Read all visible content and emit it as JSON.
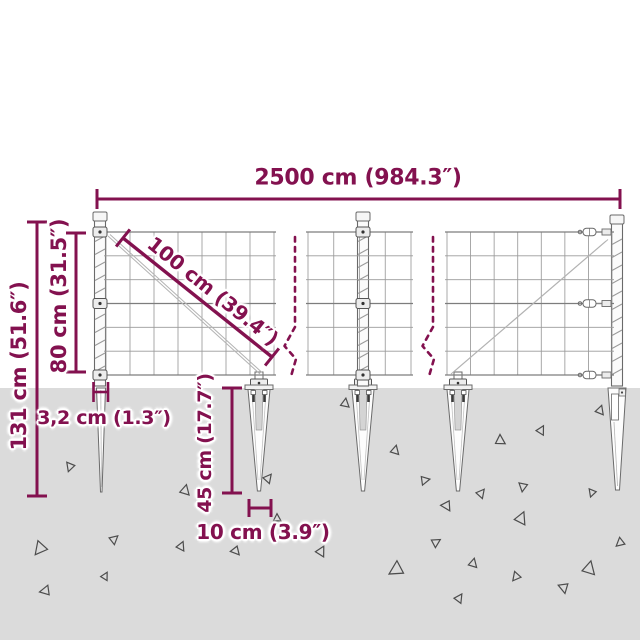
{
  "meta": {
    "title": "Wire mesh fence with spike anchors — dimension diagram"
  },
  "colors": {
    "accent": "#83114F",
    "ground": "#DBDBDB",
    "outline": "#6A6A6A",
    "mesh_wire": "#9A9A9A",
    "mesh_wire_heavy": "#7D7D7D",
    "diag_wire": "#B3B3B3",
    "triangle": "#4C4C4C"
  },
  "dimensions": {
    "total_length": {
      "label": "2500 cm (984.3″)"
    },
    "mesh_roll": {
      "label": "100 cm (39.4″)"
    },
    "mesh_height": {
      "label": "80 cm (31.5″)"
    },
    "total_height": {
      "label": "131 cm (51.6″)"
    },
    "post_diameter": {
      "label": "3,2 cm (1.3″)"
    },
    "spike_depth": {
      "label": "45 cm (17.7″)"
    },
    "spike_width": {
      "label": "10 cm (3.9″)"
    }
  },
  "scene": {
    "ground_top": 388,
    "panels": [
      {
        "x0": 106,
        "x1": 274,
        "y0": 232,
        "y1": 375,
        "cols": 7,
        "rows": 6,
        "diag": [
          108,
          236,
          260,
          374
        ]
      },
      {
        "x0": 308,
        "x1": 411,
        "y0": 232,
        "y1": 375,
        "cols": 4,
        "rows": 6,
        "diag": null
      },
      {
        "x0": 447,
        "x1": 612,
        "y0": 232,
        "y1": 375,
        "cols": 7,
        "rows": 6,
        "diag": [
          451,
          374,
          606,
          241
        ]
      }
    ],
    "posts": [
      {
        "cx": 100,
        "top": 220,
        "attach": [
          232,
          303.5,
          375
        ],
        "type": "clip"
      },
      {
        "cx": 363,
        "top": 220,
        "attach": [
          232,
          303.5,
          375
        ],
        "type": "clip"
      },
      {
        "cx": 617,
        "top": 223,
        "attach": [
          232,
          303.5,
          375
        ],
        "type": "turnbuckle"
      }
    ],
    "spikes": [
      {
        "type": "blade",
        "cx": 101
      },
      {
        "type": "cone",
        "cx": 259,
        "stub": true
      },
      {
        "type": "cone",
        "cx": 363,
        "stub": false
      },
      {
        "type": "cone",
        "cx": 458,
        "stub": true
      },
      {
        "type": "sleeve",
        "cx": 617
      }
    ],
    "break_lines": [
      {
        "x": 295
      },
      {
        "x": 433
      }
    ],
    "triangles": [
      [
        70,
        467,
        8,
        200
      ],
      [
        185,
        490,
        9,
        15
      ],
      [
        268,
        478,
        8,
        40
      ],
      [
        277,
        518,
        7,
        0
      ],
      [
        181,
        546,
        8,
        25
      ],
      [
        236,
        551,
        8,
        140
      ],
      [
        321,
        551,
        9,
        30
      ],
      [
        345,
        403,
        8,
        10
      ],
      [
        40,
        549,
        12,
        220
      ],
      [
        114,
        539,
        8,
        50
      ],
      [
        105,
        576,
        7,
        30
      ],
      [
        45,
        591,
        9,
        260
      ],
      [
        395,
        450,
        8,
        15
      ],
      [
        425,
        480,
        8,
        80
      ],
      [
        447,
        506,
        9,
        150
      ],
      [
        481,
        493,
        8,
        40
      ],
      [
        500,
        440,
        9,
        0
      ],
      [
        541,
        430,
        8,
        30
      ],
      [
        523,
        487,
        8,
        190
      ],
      [
        521,
        518,
        11,
        25
      ],
      [
        436,
        542,
        8,
        60
      ],
      [
        473,
        563,
        8,
        15
      ],
      [
        516,
        577,
        8,
        220
      ],
      [
        564,
        588,
        9,
        170
      ],
      [
        459,
        598,
        8,
        35
      ],
      [
        396,
        570,
        13,
        240
      ],
      [
        589,
        568,
        12,
        15
      ],
      [
        600,
        410,
        8,
        20
      ],
      [
        620,
        543,
        8,
        230
      ],
      [
        592,
        493,
        7,
        200
      ]
    ]
  }
}
